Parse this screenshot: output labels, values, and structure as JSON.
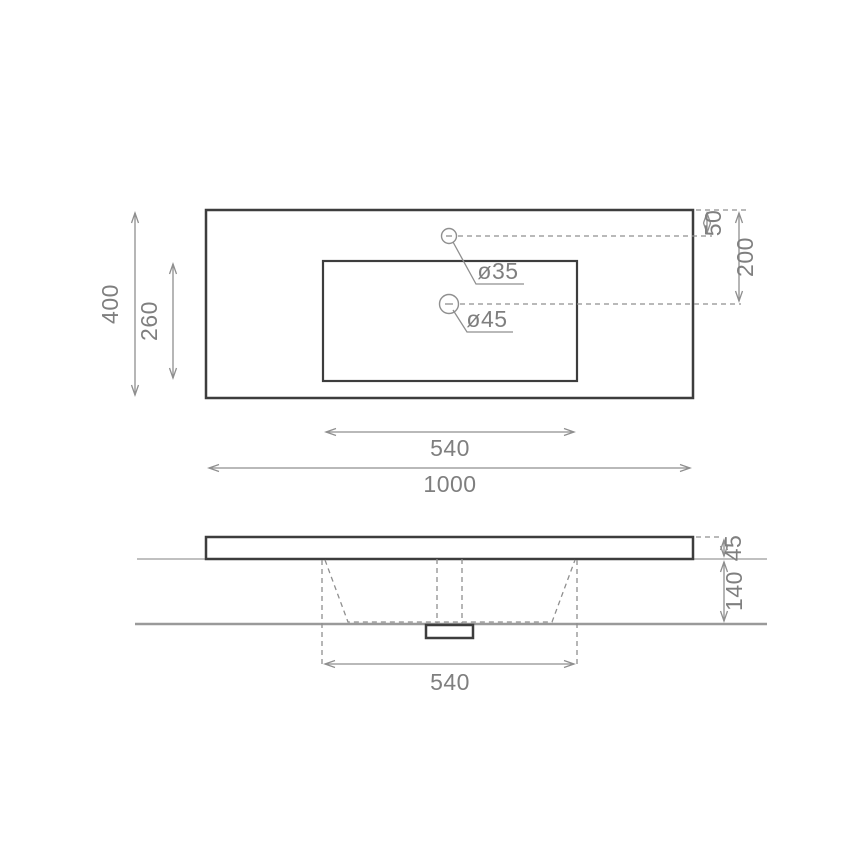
{
  "drawing": {
    "type": "washbasin-technical-drawing",
    "colors": {
      "background": "#ffffff",
      "outline": "#3d3d3d",
      "dimension_lines": "#8f8f8f",
      "dimension_text": "#7f7f7f"
    },
    "top_view": {
      "overall_width": "1000",
      "overall_depth": "400",
      "basin_cutout_width": "540",
      "basin_cutout_depth": "260",
      "faucet_hole_offset": "50",
      "drain_center_offset": "200",
      "faucet_hole_diameter": "ø35",
      "drain_hole_diameter": "ø45"
    },
    "side_view": {
      "slab_thickness": "45",
      "basin_depth": "140",
      "basin_width": "540"
    }
  }
}
